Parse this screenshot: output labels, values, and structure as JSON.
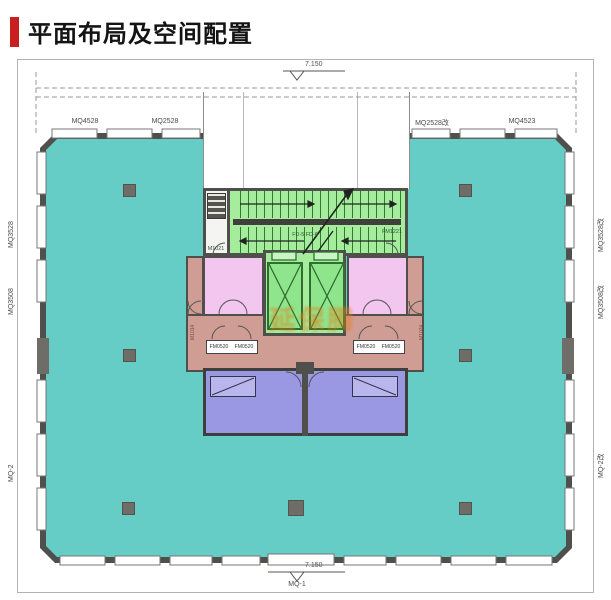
{
  "header": {
    "title": "平面布局及空间配置"
  },
  "plan": {
    "elevation_top": "7.150",
    "elevation_bottom": "7.150",
    "axis_bottom": "MQ-1",
    "windows_top": [
      "MQ4528",
      "MQ2528",
      "MQ2528改",
      "MQ4523"
    ],
    "windows_left": [
      "MQ3528",
      "MQ3508",
      "MQ-2"
    ],
    "windows_right": [
      "MQ3528改",
      "MQ3508改",
      "MQ-2改"
    ],
    "core": {
      "stair_label": "FD-5 FD-6",
      "stair_door_left": "M1021",
      "stair_door_right": "FM1221",
      "corridor_box_left": [
        "FM0520",
        "FM0520"
      ],
      "corridor_box_right": [
        "FM0520",
        "FM0520"
      ],
      "side_label_left": "M1014",
      "side_label_right": "M1024"
    },
    "watermark": "延保腾",
    "colors": {
      "open_area": "#66ccc6",
      "stair_green": "#a5ec9d",
      "elevator_green": "#8fe58c",
      "room_pink": "#f3c6ef",
      "corridor_salmon": "#cf9d94",
      "room_purple": "#9b98e3",
      "wall": "#4f4f4c",
      "accent_red": "#c91f1f"
    }
  }
}
